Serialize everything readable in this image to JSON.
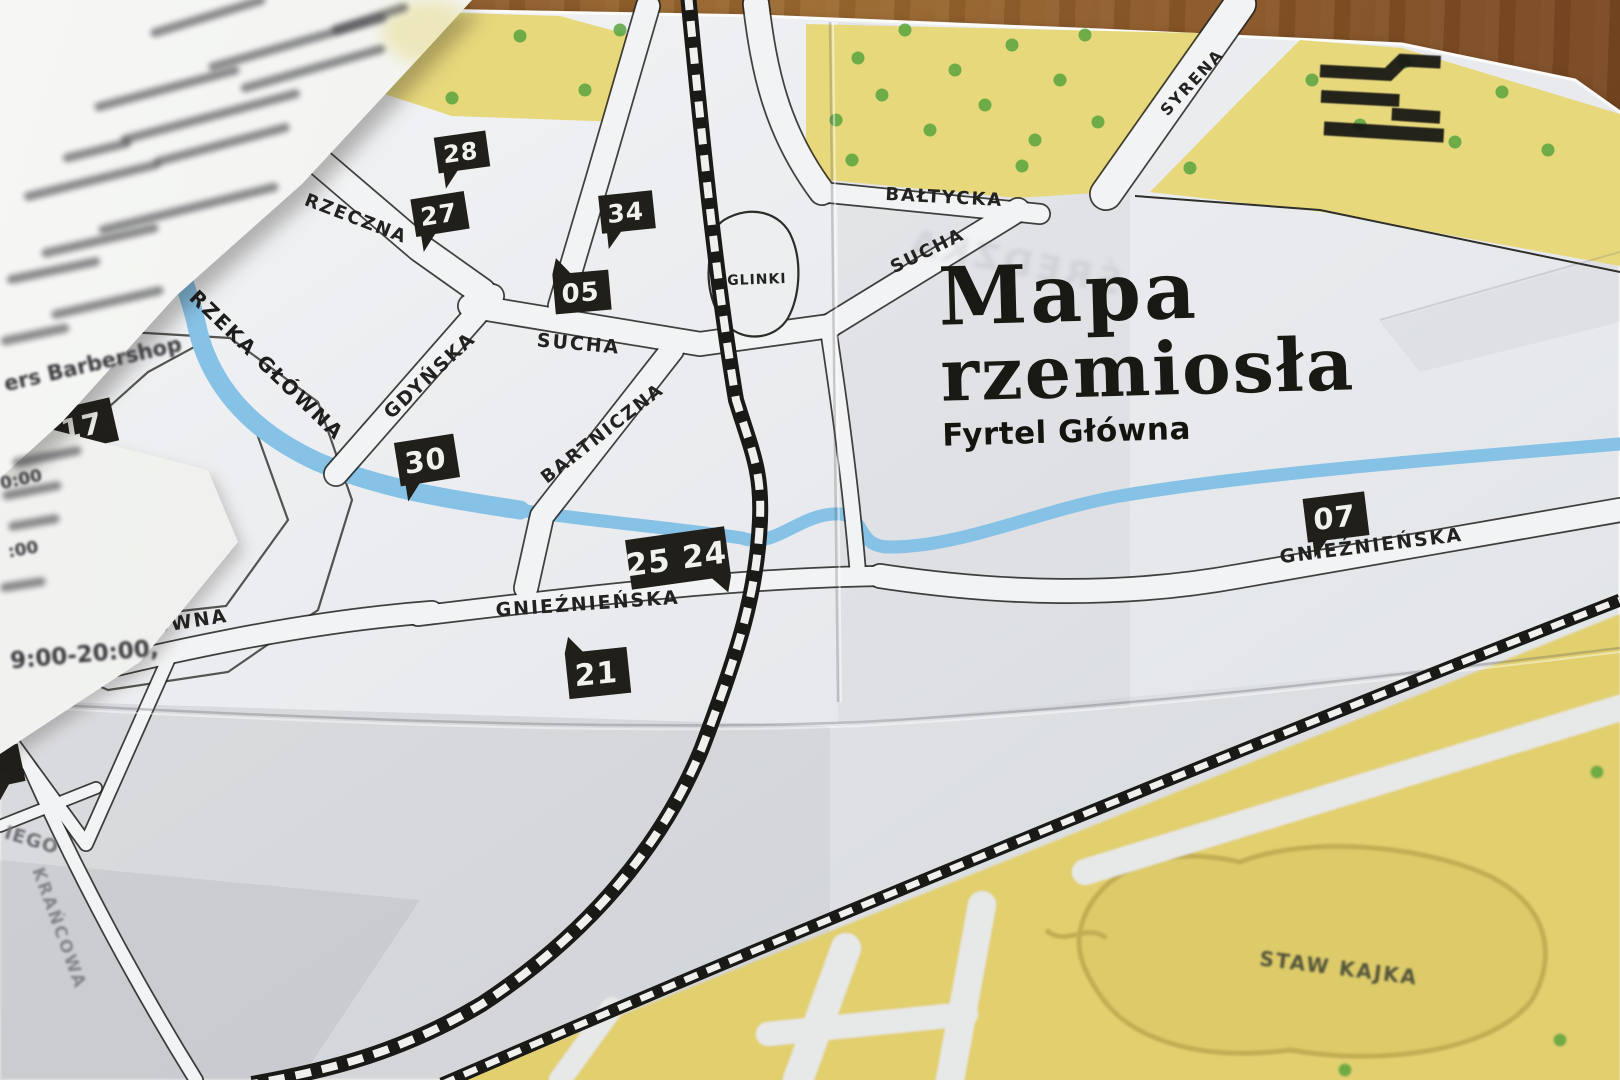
{
  "title": {
    "line1": "Mapa",
    "line2": "rzemiosła",
    "subtitle": "Fyrtel Główna",
    "show_through": "ŚREDZKA"
  },
  "colors": {
    "paper": "#e9ebee",
    "paper_bright": "#f4f5f7",
    "road_fill": "#f2f3f4",
    "ink": "#222220",
    "yellow": "#e7d87c",
    "yellow_band": "#e2cf6e",
    "pond_fill": "#ddcb69",
    "pond_stroke": "#c2ae52",
    "green": "#58a43e",
    "river": "#86c1e6",
    "rail": "#191916",
    "marker": "#201f1a",
    "marker_text": "#f1f1ee"
  },
  "streets": [
    {
      "label": "SKROMNA",
      "x": 244,
      "y": 168,
      "rot": -28,
      "size": 19,
      "ls": 2
    },
    {
      "label": "RZECZNA",
      "x": 354,
      "y": 224,
      "rot": 21,
      "size": 18,
      "ls": 2
    },
    {
      "label": "SUCHA",
      "x": 578,
      "y": 350,
      "rot": 5,
      "size": 19,
      "ls": 2
    },
    {
      "label": "GDYŃSKA",
      "x": 434,
      "y": 380,
      "rot": -43,
      "size": 19,
      "ls": 2
    },
    {
      "label": "BARTNICZNA",
      "x": 606,
      "y": 438,
      "rot": -38,
      "size": 18,
      "ls": 2
    },
    {
      "label": "BAŁTYCKA",
      "x": 944,
      "y": 203,
      "rot": 3,
      "size": 18,
      "ls": 2
    },
    {
      "label": "SUCHA",
      "x": 930,
      "y": 256,
      "rot": -26,
      "size": 18,
      "ls": 2
    },
    {
      "label": "SYRENA",
      "x": 1196,
      "y": 86,
      "rot": -47,
      "size": 16,
      "ls": 2
    },
    {
      "label": "GŁÓWNA",
      "x": 176,
      "y": 630,
      "rot": -9,
      "size": 19,
      "ls": 2
    },
    {
      "label": "GNIEŹNIEŃSKA",
      "x": 588,
      "y": 610,
      "rot": -4,
      "size": 19,
      "ls": 2
    },
    {
      "label": "GNIEŹNIEŃSKA",
      "x": 1372,
      "y": 552,
      "rot": -7,
      "size": 19,
      "ls": 2
    },
    {
      "label": "RZEKA GŁÓWNA",
      "x": 262,
      "y": 370,
      "rot": 44,
      "size": 20,
      "ls": 2,
      "color": "#1d1d1b"
    },
    {
      "label": "GLINKI",
      "x": 757,
      "y": 284,
      "rot": -2,
      "size": 14,
      "ls": 1
    },
    {
      "label": "KRAŃCOWA",
      "x": 54,
      "y": 930,
      "rot": 70,
      "size": 17,
      "ls": 2,
      "color": "#85858a",
      "blur": true
    },
    {
      "label": "IEGO",
      "x": 30,
      "y": 846,
      "rot": 17,
      "size": 19,
      "ls": 1,
      "color": "#707074",
      "blur": true
    },
    {
      "label": "STAW KAJKA",
      "x": 1338,
      "y": 975,
      "rot": 7,
      "size": 20,
      "ls": 2,
      "color": "#55553b",
      "blur": true
    }
  ],
  "markers": [
    {
      "num": "28",
      "x": 462,
      "y": 152,
      "w": 52,
      "h": 36,
      "rot": -8,
      "tail": "bl",
      "fs": 24
    },
    {
      "num": "27",
      "x": 440,
      "y": 214,
      "w": 54,
      "h": 38,
      "rot": -9,
      "tail": "bl",
      "fs": 25
    },
    {
      "num": "34",
      "x": 627,
      "y": 212,
      "w": 54,
      "h": 38,
      "rot": -6,
      "tail": "bl",
      "fs": 25
    },
    {
      "num": "05",
      "x": 582,
      "y": 292,
      "w": 56,
      "h": 40,
      "rot": -5,
      "tail": "tl",
      "fs": 26
    },
    {
      "num": "17",
      "x": 83,
      "y": 426,
      "w": 64,
      "h": 44,
      "rot": -13,
      "tail": "bl",
      "fs": 29
    },
    {
      "num": "30",
      "x": 427,
      "y": 460,
      "w": 60,
      "h": 44,
      "rot": -9,
      "tail": "bl",
      "fs": 29
    },
    {
      "num": "25 24",
      "x": 678,
      "y": 558,
      "w": 100,
      "h": 50,
      "rot": -8,
      "tail": "br",
      "fs": 31
    },
    {
      "num": "21",
      "x": 598,
      "y": 673,
      "w": 62,
      "h": 46,
      "rot": -6,
      "tail": "tl",
      "fs": 30
    },
    {
      "num": "16",
      "x": 16,
      "y": 676,
      "w": 66,
      "h": 46,
      "rot": -10,
      "tail": "bl",
      "fs": 30
    },
    {
      "num": "07",
      "x": 1336,
      "y": 517,
      "w": 62,
      "h": 44,
      "rot": -7,
      "tail": "bl",
      "fs": 29
    },
    {
      "num": "",
      "x": 4,
      "y": 766,
      "w": 36,
      "h": 38,
      "rot": -12,
      "tail": "bl",
      "fs": 0
    }
  ],
  "trees": [
    {
      "x": 300,
      "y": 28
    },
    {
      "x": 348,
      "y": 88
    },
    {
      "x": 395,
      "y": 55
    },
    {
      "x": 452,
      "y": 98
    },
    {
      "x": 520,
      "y": 36
    },
    {
      "x": 585,
      "y": 90
    },
    {
      "x": 620,
      "y": 30
    },
    {
      "x": 836,
      "y": 120
    },
    {
      "x": 858,
      "y": 58
    },
    {
      "x": 882,
      "y": 95
    },
    {
      "x": 905,
      "y": 30
    },
    {
      "x": 930,
      "y": 130
    },
    {
      "x": 955,
      "y": 70
    },
    {
      "x": 985,
      "y": 105
    },
    {
      "x": 1012,
      "y": 45
    },
    {
      "x": 1035,
      "y": 140
    },
    {
      "x": 1060,
      "y": 80
    },
    {
      "x": 1085,
      "y": 35
    },
    {
      "x": 1098,
      "y": 122
    },
    {
      "x": 852,
      "y": 160
    },
    {
      "x": 1022,
      "y": 166
    },
    {
      "x": 1190,
      "y": 168
    },
    {
      "x": 1312,
      "y": 80
    },
    {
      "x": 1360,
      "y": 125
    },
    {
      "x": 1405,
      "y": 62
    },
    {
      "x": 1455,
      "y": 142
    },
    {
      "x": 1502,
      "y": 92
    },
    {
      "x": 1548,
      "y": 150
    },
    {
      "x": 1597,
      "y": 772
    },
    {
      "x": 1560,
      "y": 1040
    },
    {
      "x": 1345,
      "y": 1070
    }
  ],
  "legend_sheet": {
    "fragments": [
      {
        "text": "ers Barbershop",
        "x": 2,
        "y": 352,
        "rot": -13,
        "size": 21
      },
      {
        "text": "0:00",
        "x": 0,
        "y": 470,
        "rot": -12,
        "size": 17
      },
      {
        "text": ":00",
        "x": 8,
        "y": 540,
        "rot": -10,
        "size": 17
      },
      {
        "text": "9:00-20:00,",
        "x": 10,
        "y": 642,
        "rot": -5,
        "size": 23
      }
    ]
  },
  "logo": {
    "name": "fyrtel-brand-mark"
  }
}
